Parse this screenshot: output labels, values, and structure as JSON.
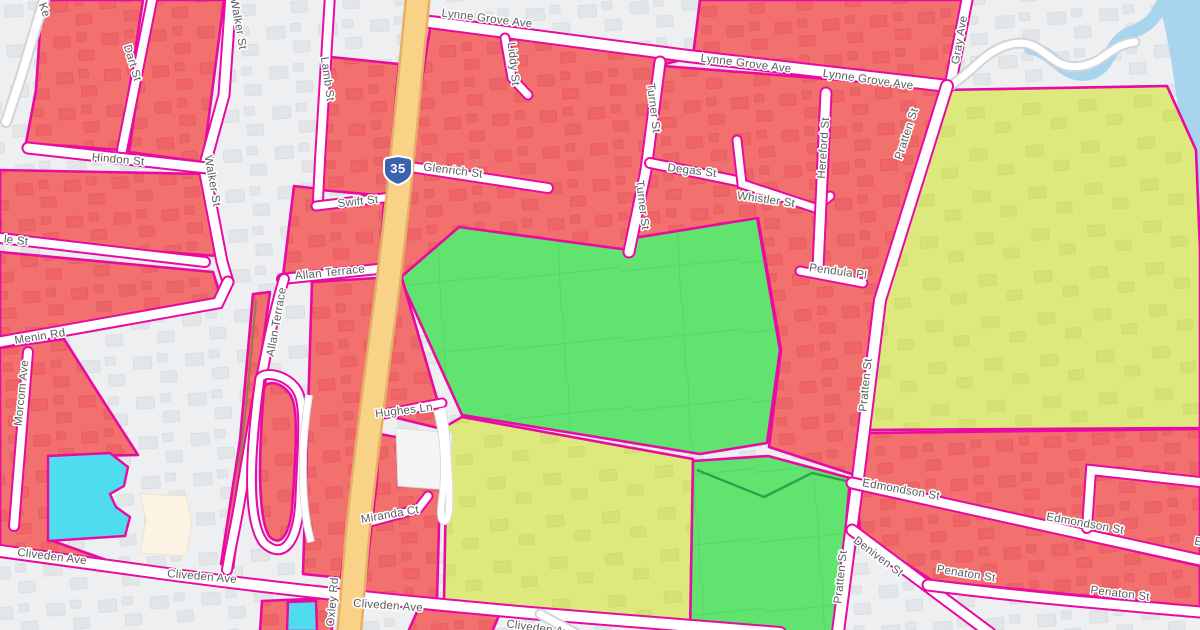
{
  "map": {
    "description": "street map with magenta-outlined red, green and yellow-green overlay zones",
    "route_shield": {
      "number": "35"
    },
    "colors": {
      "zone_red": "#F2706E",
      "zone_green": "#61E370",
      "zone_yellow_green": "#DEE97D",
      "boundary_magenta": "#E80AA2",
      "water_cyan": "#4FDCEF",
      "river_blue": "#A9D4EE",
      "major_road_yellow": "#F8D287",
      "road_white": "#FFFFFF",
      "background": "#EDEFF1",
      "label_gray": "#5B5C5E",
      "shield_blue": "#3A63AE"
    },
    "street_labels": [
      {
        "text": "Ke",
        "x": 44,
        "y": 10,
        "rot": 70
      },
      {
        "text": "Walker St",
        "x": 238,
        "y": 24,
        "rot": 80
      },
      {
        "text": "Dart St",
        "x": 132,
        "y": 63,
        "rot": 73
      },
      {
        "text": "Lamb St",
        "x": 327,
        "y": 79,
        "rot": 82
      },
      {
        "text": "Hindon St",
        "x": 118,
        "y": 160,
        "rot": 5
      },
      {
        "text": "Walker St",
        "x": 212,
        "y": 181,
        "rot": 80
      },
      {
        "text": "le St",
        "x": 16,
        "y": 241,
        "rot": 6
      },
      {
        "text": "Swift St",
        "x": 358,
        "y": 202,
        "rot": -6
      },
      {
        "text": "Lynne Grove Ave",
        "x": 487,
        "y": 19,
        "rot": 7
      },
      {
        "text": "Liddy St",
        "x": 513,
        "y": 64,
        "rot": 84
      },
      {
        "text": "Lynne Grove Ave",
        "x": 746,
        "y": 64,
        "rot": 7
      },
      {
        "text": "Lynne Grove Ave",
        "x": 868,
        "y": 80,
        "rot": 8
      },
      {
        "text": "Gray Ave",
        "x": 960,
        "y": 40,
        "rot": -80
      },
      {
        "text": "Glenrich St",
        "x": 453,
        "y": 171,
        "rot": 7
      },
      {
        "text": "Turner St",
        "x": 653,
        "y": 108,
        "rot": 83
      },
      {
        "text": "Turner St",
        "x": 642,
        "y": 205,
        "rot": 83
      },
      {
        "text": "Degas St",
        "x": 692,
        "y": 171,
        "rot": 7
      },
      {
        "text": "Whistler St",
        "x": 766,
        "y": 200,
        "rot": 8
      },
      {
        "text": "Hereford St",
        "x": 824,
        "y": 148,
        "rot": -86
      },
      {
        "text": "Pratten St",
        "x": 907,
        "y": 134,
        "rot": -72
      },
      {
        "text": "Pendula Pl",
        "x": 838,
        "y": 272,
        "rot": 8
      },
      {
        "text": "Allan Terrace",
        "x": 330,
        "y": 273,
        "rot": -6
      },
      {
        "text": "Allan Terrace",
        "x": 277,
        "y": 322,
        "rot": -80
      },
      {
        "text": "Menin Rd",
        "x": 40,
        "y": 337,
        "rot": -9
      },
      {
        "text": "Morcom Ave",
        "x": 22,
        "y": 393,
        "rot": -84
      },
      {
        "text": "Hughes Ln",
        "x": 404,
        "y": 411,
        "rot": -7
      },
      {
        "text": "Pratten St",
        "x": 866,
        "y": 385,
        "rot": -84
      },
      {
        "text": "Miranda Ct",
        "x": 390,
        "y": 515,
        "rot": -10
      },
      {
        "text": "Cliveden Ave",
        "x": 52,
        "y": 557,
        "rot": 7
      },
      {
        "text": "Cliveden Ave",
        "x": 202,
        "y": 577,
        "rot": 5
      },
      {
        "text": "Oxley Rd",
        "x": 333,
        "y": 602,
        "rot": -85
      },
      {
        "text": "Cliveden Ave",
        "x": 388,
        "y": 606,
        "rot": 4
      },
      {
        "text": "Cliveden Ave",
        "x": 541,
        "y": 629,
        "rot": 8
      },
      {
        "text": "Edmondson St",
        "x": 901,
        "y": 490,
        "rot": 10
      },
      {
        "text": "Edmondson St",
        "x": 1085,
        "y": 524,
        "rot": 10
      },
      {
        "text": "Edmondson St",
        "x": 1233,
        "y": 549,
        "rot": 11
      },
      {
        "text": "Deniven St",
        "x": 878,
        "y": 557,
        "rot": 37
      },
      {
        "text": "Penaton St",
        "x": 966,
        "y": 574,
        "rot": 9
      },
      {
        "text": "Penaton St",
        "x": 1120,
        "y": 594,
        "rot": 7
      },
      {
        "text": "Pratten St",
        "x": 841,
        "y": 577,
        "rot": -84
      }
    ]
  }
}
